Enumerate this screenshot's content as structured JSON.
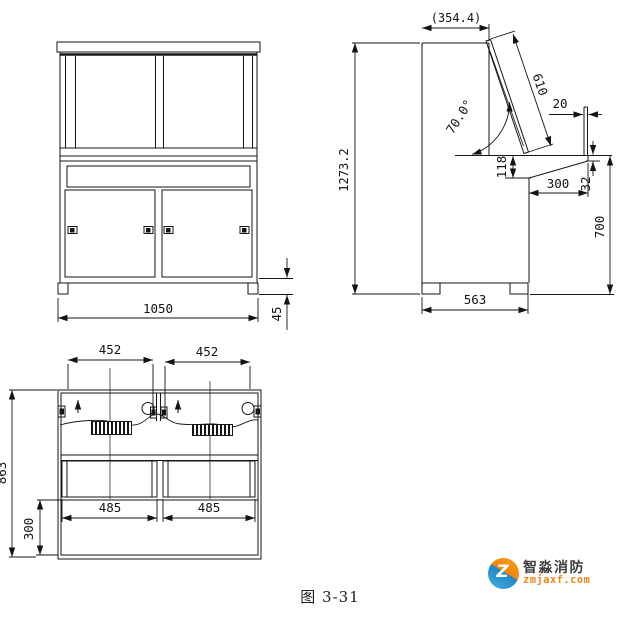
{
  "figure": {
    "caption": "图 3-31"
  },
  "front_view": {
    "dims": {
      "overall_width": "1050",
      "foot_height": "45"
    }
  },
  "side_view": {
    "dims": {
      "top_depth": "(354.4)",
      "overall_height": "1273.2",
      "panel_length": "610",
      "panel_angle": "70.0°",
      "ledge_width": "20",
      "apron_height": "118",
      "desk_overhang": "300",
      "edge_thickness": "32",
      "desk_height": "700",
      "base_depth": "563"
    }
  },
  "plan_view": {
    "dims": {
      "left_module_width": "452",
      "right_module_width": "452",
      "overall_depth": "863",
      "front_overhang": "300",
      "left_opening_width": "485",
      "right_opening_width": "485"
    }
  },
  "logo": {
    "company": "智淼消防",
    "website": "zmjaxf.com",
    "monogram": "Z",
    "colors": {
      "orange": "#f08306",
      "blue": "#2186c4",
      "text": "#3e3e3e"
    }
  }
}
